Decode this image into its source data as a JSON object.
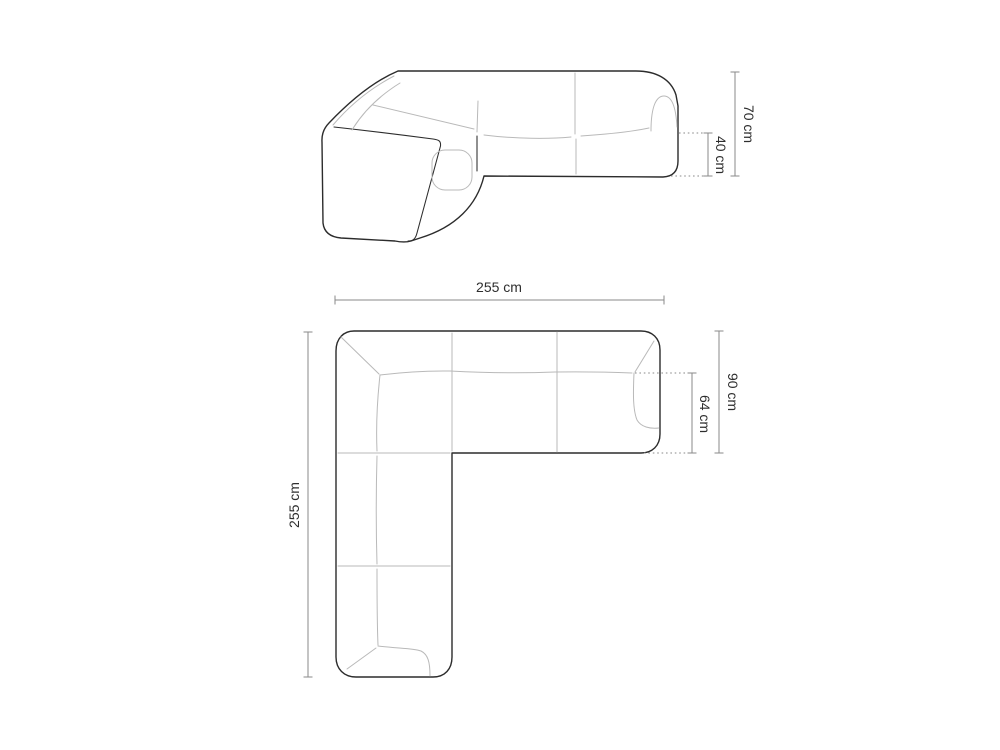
{
  "colors": {
    "background": "#ffffff",
    "outline": "#2c2c2c",
    "seam": "#b9b9b9",
    "dimension": "#8a8a8a",
    "label": "#2e2e2e"
  },
  "views": {
    "front": {
      "dimensions": {
        "total_height": "70 cm",
        "seat_height": "40 cm"
      }
    },
    "top": {
      "dimensions": {
        "total_width": "255 cm",
        "total_depth": "255 cm",
        "body_depth": "90 cm",
        "seat_depth": "64 cm"
      }
    }
  }
}
